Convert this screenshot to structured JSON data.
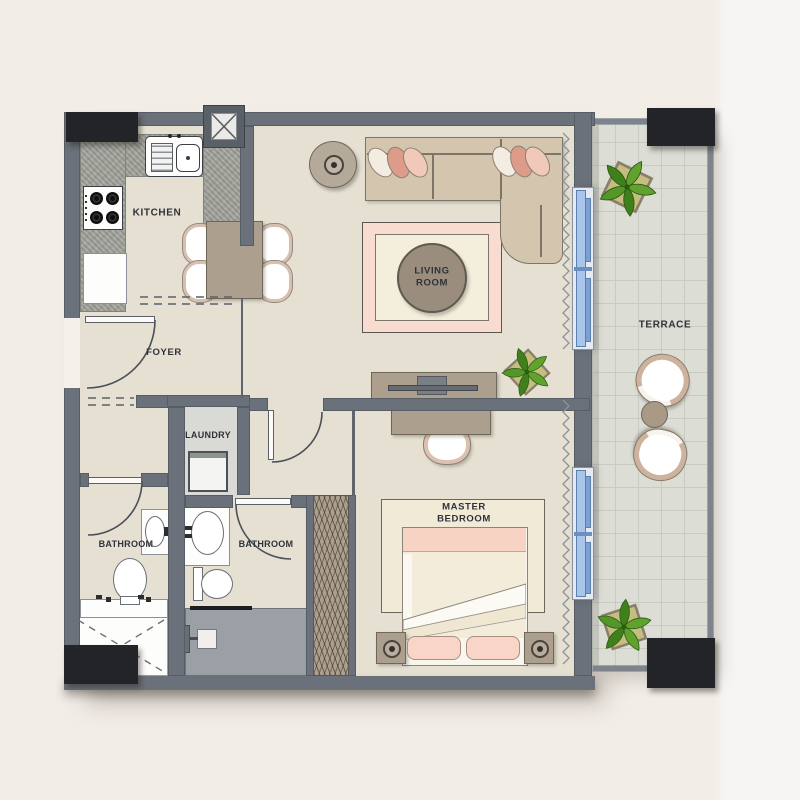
{
  "rooms": {
    "kitchen": "KITCHEN",
    "foyer": "FOYER",
    "laundry": "LAUNDRY",
    "bathroom_small": "BATHROOM",
    "bathroom_master": "BATHROOM",
    "living_room": "LIVING ROOM",
    "master_bedroom": "MASTER BEDROOM",
    "terrace": "TERRACE"
  },
  "colors": {
    "bg": "#f2ede7",
    "bg_right": "#f6f5f3",
    "floor": "#e5e0d2",
    "wall": "#6b717a",
    "column": "#232427",
    "counter": "#a9a9a3",
    "tan": "#ac9f8e",
    "tan_dark": "#6f6759",
    "sofa": "#d3c5ae",
    "sofa_line": "#7d7567",
    "pink": "#dd9b89",
    "pink_light": "#f0c9bb",
    "cream": "#f3ece1",
    "rug_pink": "#f8dcd0",
    "rug_cream": "#f4eedd",
    "bed_cream": "#f3ecdb",
    "bed_pink": "#f7d3c3",
    "window_glass": "#a9c6ea",
    "window_deep": "#5b7fae",
    "window_frame": "#e4e9f2",
    "terrace_floor": "#dcddd5",
    "terrace_grid": "#c9cbc2",
    "terrace_wall": "#7e848c",
    "shower": "#9ba0a6",
    "niche": "#d9d9d5",
    "plant": "#4e8f22",
    "plant_dark": "#2e6414",
    "planter": "#c6bd80",
    "ink": "#2f323a",
    "white_fix": "#fdfdfb",
    "fix_border": "#70757c",
    "curtain": "#8d939b",
    "arc": "#4a5058"
  }
}
